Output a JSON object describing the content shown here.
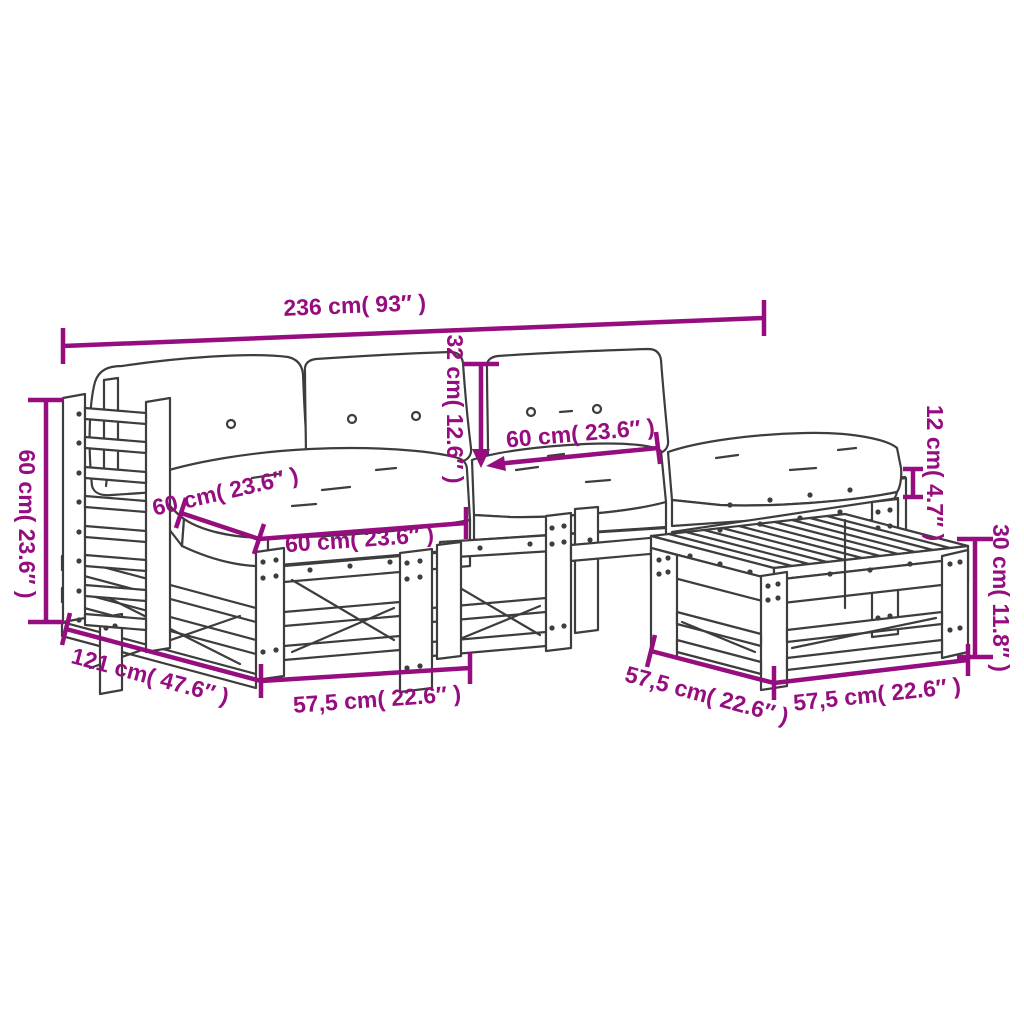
{
  "colors": {
    "dimension": "#950d7e",
    "line_art": "#3d3d3d",
    "background": "#ffffff"
  },
  "dimensions": {
    "overall_width": "236 cm( 93″ )",
    "armrest_height": "60 cm( 23.6″ )",
    "seat_depth": "60 cm( 23.6″ )",
    "seat_width": "60 cm( 23.6″ )",
    "back_cushion_height": "32 cm( 12.6″ )",
    "back_cushion_width": "60 cm( 23.6″ )",
    "seat_cushion_thickness": "12 cm( 4.7″ )",
    "table_height": "30 cm( 11.8″ )",
    "total_depth": "121 cm( 47.6″ )",
    "module_width": "57,5 cm( 22.6″ )",
    "table_depth": "57,5 cm( 22.6″ )",
    "table_width": "57,5 cm( 22.6″ )"
  }
}
